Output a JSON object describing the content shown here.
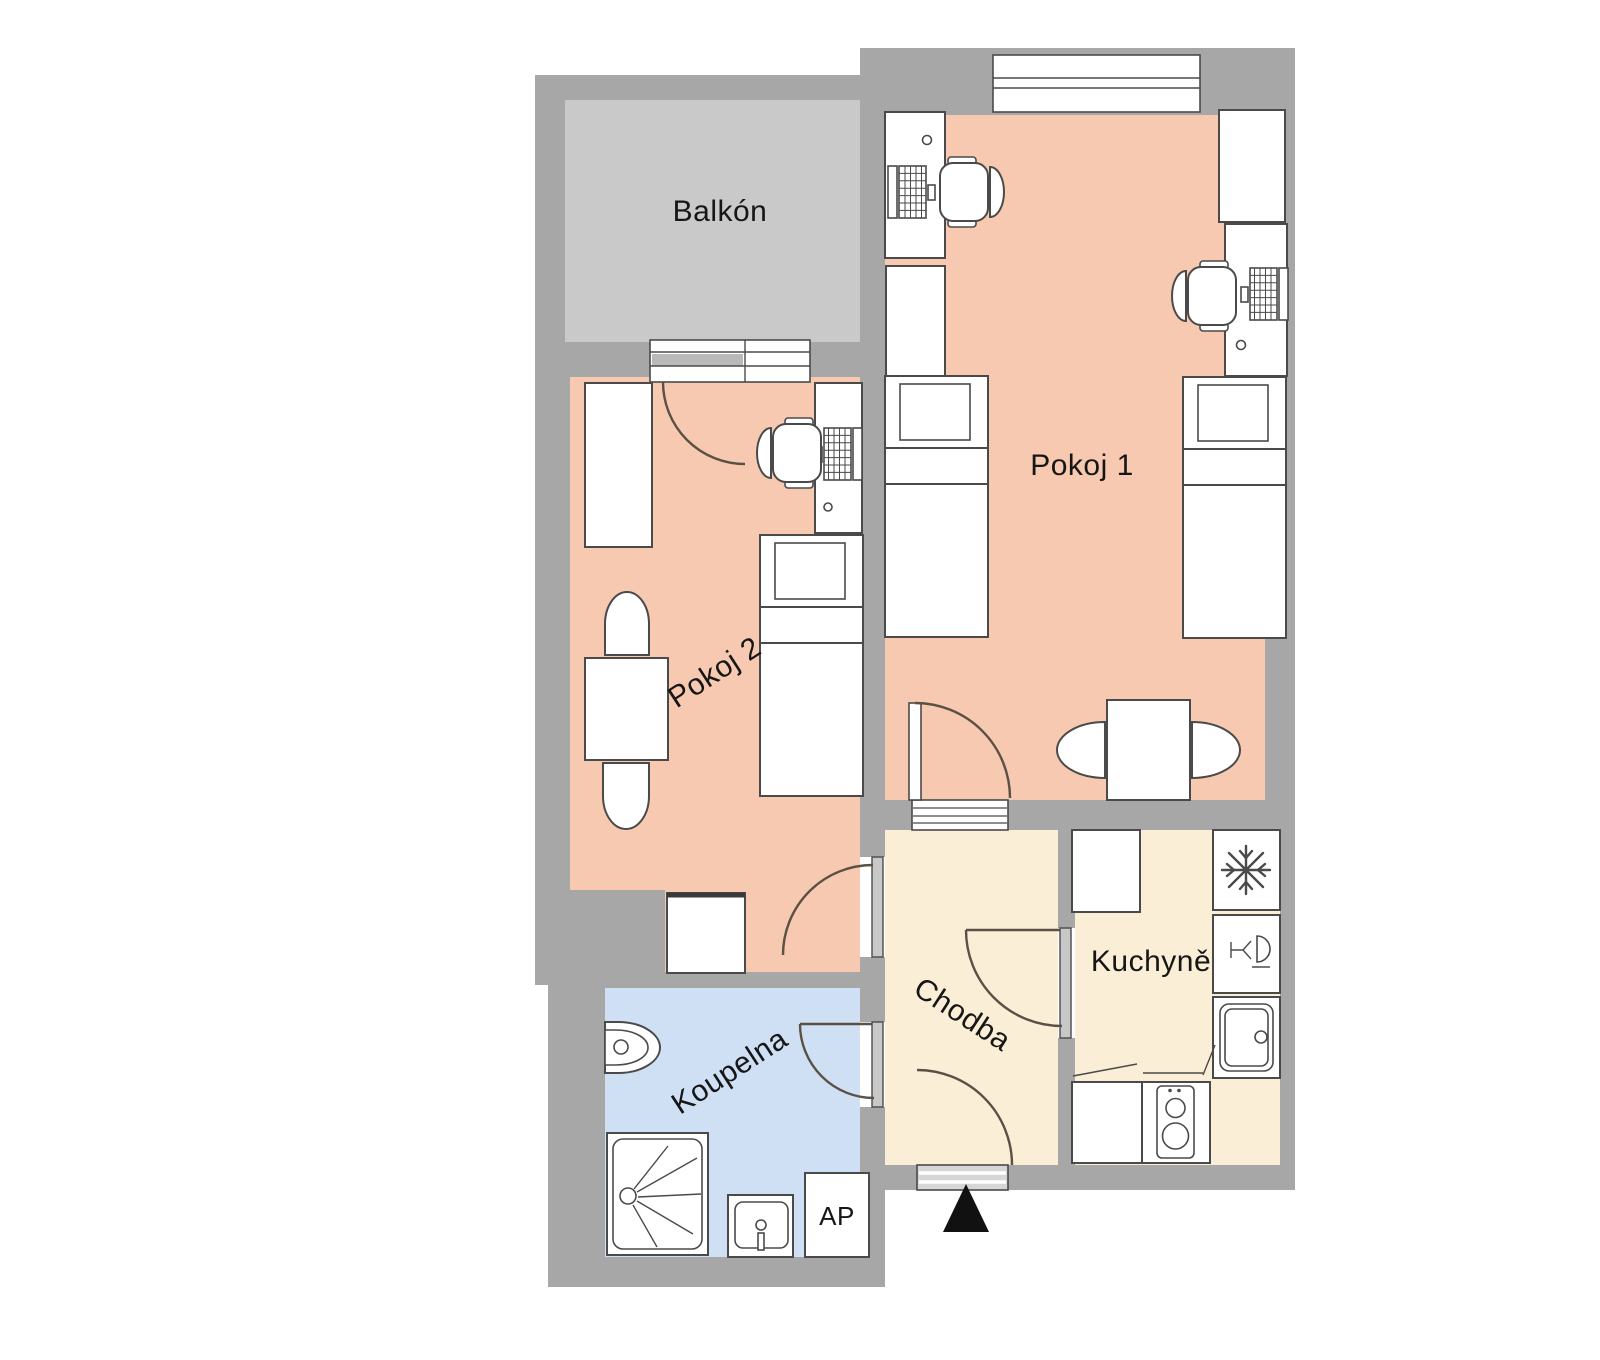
{
  "rooms": {
    "balkon": {
      "label": "Balkón"
    },
    "pokoj1": {
      "label": "Pokoj 1"
    },
    "pokoj2": {
      "label": "Pokoj 2"
    },
    "chodba": {
      "label": "Chodba"
    },
    "kuchyne": {
      "label": "Kuchyně"
    },
    "koupelna": {
      "label": "Koupelna"
    }
  },
  "appliances": {
    "washing_machine_label": "AP"
  },
  "icons": {
    "freezer": "snowflake-icon",
    "dishwasher": "glass-and-plate-icon",
    "stove": "two-burner-icon",
    "kitchen_sink": "basin-with-drain-icon",
    "bath_sink": "basin-with-faucet-icon",
    "shower": "spray-rays-icon",
    "toilet": "bowl-icon",
    "computer": "laptop-icon",
    "entrance": "black-triangle-arrow"
  },
  "colors": {
    "canvas": "#ffffff",
    "wall": "#a7a7a7",
    "balcony_floor": "#c9c9c9",
    "bedroom_floor": "#f8c9b1",
    "hall_floor": "#fbeed6",
    "bath_floor": "#cfe0f4",
    "outline": "#4a4a4a",
    "door_arc": "#5a5045",
    "arrow": "#111111"
  }
}
